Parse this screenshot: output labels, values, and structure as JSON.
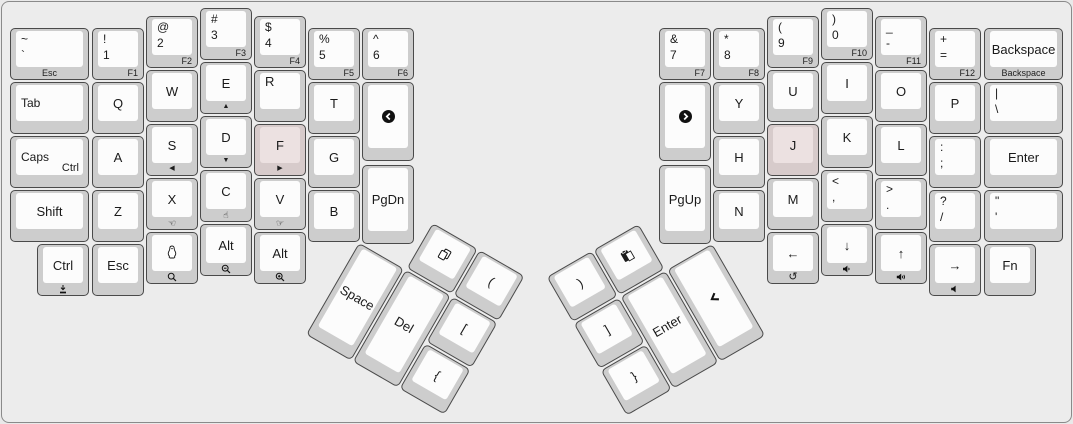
{
  "keyboard": {
    "description": "Split ergonomic keyboard layout (ErgoDox-style), two halves with rotated thumb clusters",
    "colors": {
      "case_background": "#ececec",
      "case_border": "#8a8a8a",
      "keycap_side": "#cdcdcd",
      "keycap_top": "#fcfcfc",
      "keycap_border": "#4a4a4a",
      "homing_side": "#d7cbcb",
      "homing_top": "#ece1e1",
      "legend": "#1a1a1a"
    },
    "keys": [
      {
        "n": "grave-esc",
        "x": 10,
        "y": 28,
        "w": 79,
        "tl": [
          "~",
          "`"
        ],
        "f": "Esc",
        "fa": "c"
      },
      {
        "n": "1-f1",
        "x": 92,
        "y": 28,
        "tl": [
          "!",
          "1"
        ],
        "f": "F1",
        "fa": "r"
      },
      {
        "n": "2-f2",
        "x": 146,
        "y": 16,
        "tl": [
          "@",
          "2"
        ],
        "f": "F2",
        "fa": "r"
      },
      {
        "n": "3-f3",
        "x": 200,
        "y": 8,
        "tl": [
          "#",
          "3"
        ],
        "f": "F3",
        "fa": "r"
      },
      {
        "n": "4-f4",
        "x": 254,
        "y": 16,
        "tl": [
          "$",
          "4"
        ],
        "f": "F4",
        "fa": "r"
      },
      {
        "n": "5-f5",
        "x": 308,
        "y": 28,
        "tl": [
          "%",
          "5"
        ],
        "f": "F5",
        "fa": "r"
      },
      {
        "n": "6-f6",
        "x": 362,
        "y": 28,
        "tl": [
          "^",
          "6"
        ],
        "f": "F6",
        "fa": "r"
      },
      {
        "n": "tab",
        "x": 10,
        "y": 82,
        "w": 79,
        "l": "Tab"
      },
      {
        "n": "q",
        "x": 92,
        "y": 82,
        "c": "Q"
      },
      {
        "n": "w",
        "x": 146,
        "y": 70,
        "c": "W"
      },
      {
        "n": "e",
        "x": 200,
        "y": 62,
        "c": "E",
        "fi": "triangle-up"
      },
      {
        "n": "r",
        "x": 254,
        "y": 70,
        "tl1": "R"
      },
      {
        "n": "t",
        "x": 308,
        "y": 82,
        "c": "T"
      },
      {
        "n": "back-circle",
        "x": 362,
        "y": 82,
        "h": 79,
        "mi": "circle-left"
      },
      {
        "n": "caps-ctrl",
        "x": 10,
        "y": 136,
        "w": 79,
        "l": "Caps",
        "br": "Ctrl"
      },
      {
        "n": "a",
        "x": 92,
        "y": 136,
        "c": "A"
      },
      {
        "n": "s",
        "x": 146,
        "y": 124,
        "c": "S",
        "fi": "triangle-left"
      },
      {
        "n": "d",
        "x": 200,
        "y": 116,
        "c": "D",
        "fi": "triangle-down"
      },
      {
        "n": "f",
        "x": 254,
        "y": 124,
        "c": "F",
        "fi": "triangle-right",
        "hm": true
      },
      {
        "n": "g",
        "x": 308,
        "y": 136,
        "c": "G"
      },
      {
        "n": "pgdn",
        "x": 362,
        "y": 165,
        "h": 79,
        "c": "PgDn"
      },
      {
        "n": "shift",
        "x": 10,
        "y": 190,
        "w": 79,
        "c": "Shift"
      },
      {
        "n": "z",
        "x": 92,
        "y": 190,
        "c": "Z"
      },
      {
        "n": "x",
        "x": 146,
        "y": 178,
        "c": "X",
        "fi": "hand-left"
      },
      {
        "n": "c",
        "x": 200,
        "y": 170,
        "c": "C",
        "fi": "hand-up"
      },
      {
        "n": "v",
        "x": 254,
        "y": 178,
        "c": "V",
        "fi": "hand-right"
      },
      {
        "n": "b",
        "x": 308,
        "y": 190,
        "c": "B"
      },
      {
        "n": "ctrl-bottom",
        "x": 37,
        "y": 244,
        "c": "Ctrl",
        "fi": "download"
      },
      {
        "n": "esc-bottom",
        "x": 92,
        "y": 244,
        "c": "Esc"
      },
      {
        "n": "penguin",
        "x": 146,
        "y": 232,
        "mi": "penguin",
        "fi": "search"
      },
      {
        "n": "alt-1",
        "x": 200,
        "y": 224,
        "c": "Alt",
        "fi": "search-minus"
      },
      {
        "n": "alt-2",
        "x": 254,
        "y": 232,
        "c": "Alt",
        "fi": "search-plus"
      },
      {
        "n": "7-f7",
        "x": 659,
        "y": 28,
        "tl": [
          "&",
          "7"
        ],
        "f": "F7",
        "fa": "r"
      },
      {
        "n": "8-f8",
        "x": 713,
        "y": 28,
        "tl": [
          "*",
          "8"
        ],
        "f": "F8",
        "fa": "r"
      },
      {
        "n": "9-f9",
        "x": 767,
        "y": 16,
        "tl": [
          "(",
          "9"
        ],
        "f": "F9",
        "fa": "r"
      },
      {
        "n": "0-f10",
        "x": 821,
        "y": 8,
        "tl": [
          ")",
          "0"
        ],
        "f": "F10",
        "fa": "r"
      },
      {
        "n": "dash-f11",
        "x": 875,
        "y": 16,
        "tl": [
          "_",
          "-"
        ],
        "f": "F11",
        "fa": "r"
      },
      {
        "n": "equals-f12",
        "x": 929,
        "y": 28,
        "tl": [
          "+",
          "="
        ],
        "f": "F12",
        "fa": "r"
      },
      {
        "n": "backspace",
        "x": 984,
        "y": 28,
        "w": 79,
        "c": "Backspace",
        "f": "Backspace",
        "fa": "c"
      },
      {
        "n": "fwd-circle",
        "x": 659,
        "y": 82,
        "h": 79,
        "mi": "circle-right"
      },
      {
        "n": "y",
        "x": 713,
        "y": 82,
        "c": "Y"
      },
      {
        "n": "u",
        "x": 767,
        "y": 70,
        "c": "U"
      },
      {
        "n": "i",
        "x": 821,
        "y": 62,
        "c": "I"
      },
      {
        "n": "o",
        "x": 875,
        "y": 70,
        "c": "O"
      },
      {
        "n": "p",
        "x": 929,
        "y": 82,
        "c": "P"
      },
      {
        "n": "pipe-backslash",
        "x": 984,
        "y": 82,
        "w": 79,
        "tl": [
          "|",
          "\\"
        ]
      },
      {
        "n": "pgup",
        "x": 659,
        "y": 165,
        "h": 79,
        "c": "PgUp"
      },
      {
        "n": "h",
        "x": 713,
        "y": 136,
        "c": "H"
      },
      {
        "n": "j",
        "x": 767,
        "y": 124,
        "c": "J",
        "hm": true
      },
      {
        "n": "k",
        "x": 821,
        "y": 116,
        "c": "K"
      },
      {
        "n": "l",
        "x": 875,
        "y": 124,
        "c": "L"
      },
      {
        "n": "colon-semicolon",
        "x": 929,
        "y": 136,
        "tl": [
          ":",
          ";"
        ]
      },
      {
        "n": "enter-right",
        "x": 984,
        "y": 136,
        "w": 79,
        "c": "Enter"
      },
      {
        "n": "n-key",
        "x": 713,
        "y": 190,
        "c": "N"
      },
      {
        "n": "m",
        "x": 767,
        "y": 178,
        "c": "M"
      },
      {
        "n": "comma",
        "x": 821,
        "y": 170,
        "tl": [
          "<",
          ","
        ]
      },
      {
        "n": "period",
        "x": 875,
        "y": 178,
        "tl": [
          ">",
          "."
        ]
      },
      {
        "n": "slash",
        "x": 929,
        "y": 190,
        "tl": [
          "?",
          "/"
        ]
      },
      {
        "n": "quote",
        "x": 984,
        "y": 190,
        "w": 79,
        "tl": [
          "\"",
          "'"
        ]
      },
      {
        "n": "arrow-left",
        "x": 767,
        "y": 232,
        "c": "←",
        "fi": "undo"
      },
      {
        "n": "arrow-down",
        "x": 821,
        "y": 224,
        "c": "↓",
        "fi": "vol-down"
      },
      {
        "n": "arrow-up",
        "x": 875,
        "y": 232,
        "c": "↑",
        "fi": "vol-up"
      },
      {
        "n": "arrow-right",
        "x": 929,
        "y": 244,
        "c": "→",
        "fi": "vol-mute"
      },
      {
        "n": "fn",
        "x": 984,
        "y": 244,
        "c": "Fn"
      },
      {
        "n": "copy",
        "x": 54,
        "y": 0,
        "cl": "L",
        "mi": "copy"
      },
      {
        "n": "paren-open",
        "x": 108,
        "y": 0,
        "cl": "L",
        "c": "("
      },
      {
        "n": "space",
        "x": 0,
        "y": 54,
        "h": 106,
        "cl": "L",
        "c": "Space"
      },
      {
        "n": "del",
        "x": 54,
        "y": 54,
        "h": 106,
        "cl": "L",
        "c": "Del"
      },
      {
        "n": "bracket-open",
        "x": 108,
        "y": 54,
        "cl": "L",
        "c": "["
      },
      {
        "n": "brace-open",
        "x": 108,
        "y": 108,
        "cl": "L",
        "c": "{"
      },
      {
        "n": "paren-close",
        "x": 0,
        "y": 0,
        "cl": "R",
        "c": ")"
      },
      {
        "n": "paste",
        "x": 54,
        "y": 0,
        "cl": "R",
        "mi": "paste"
      },
      {
        "n": "bracket-close",
        "x": 0,
        "y": 54,
        "cl": "R",
        "c": "]"
      },
      {
        "n": "enter-thumb",
        "x": 54,
        "y": 54,
        "h": 106,
        "cl": "R",
        "c": "Enter"
      },
      {
        "n": "phone",
        "x": 108,
        "y": 54,
        "h": 106,
        "cl": "R",
        "mi": "phone"
      },
      {
        "n": "brace-close",
        "x": 0,
        "y": 108,
        "cl": "R",
        "c": "}"
      }
    ]
  }
}
